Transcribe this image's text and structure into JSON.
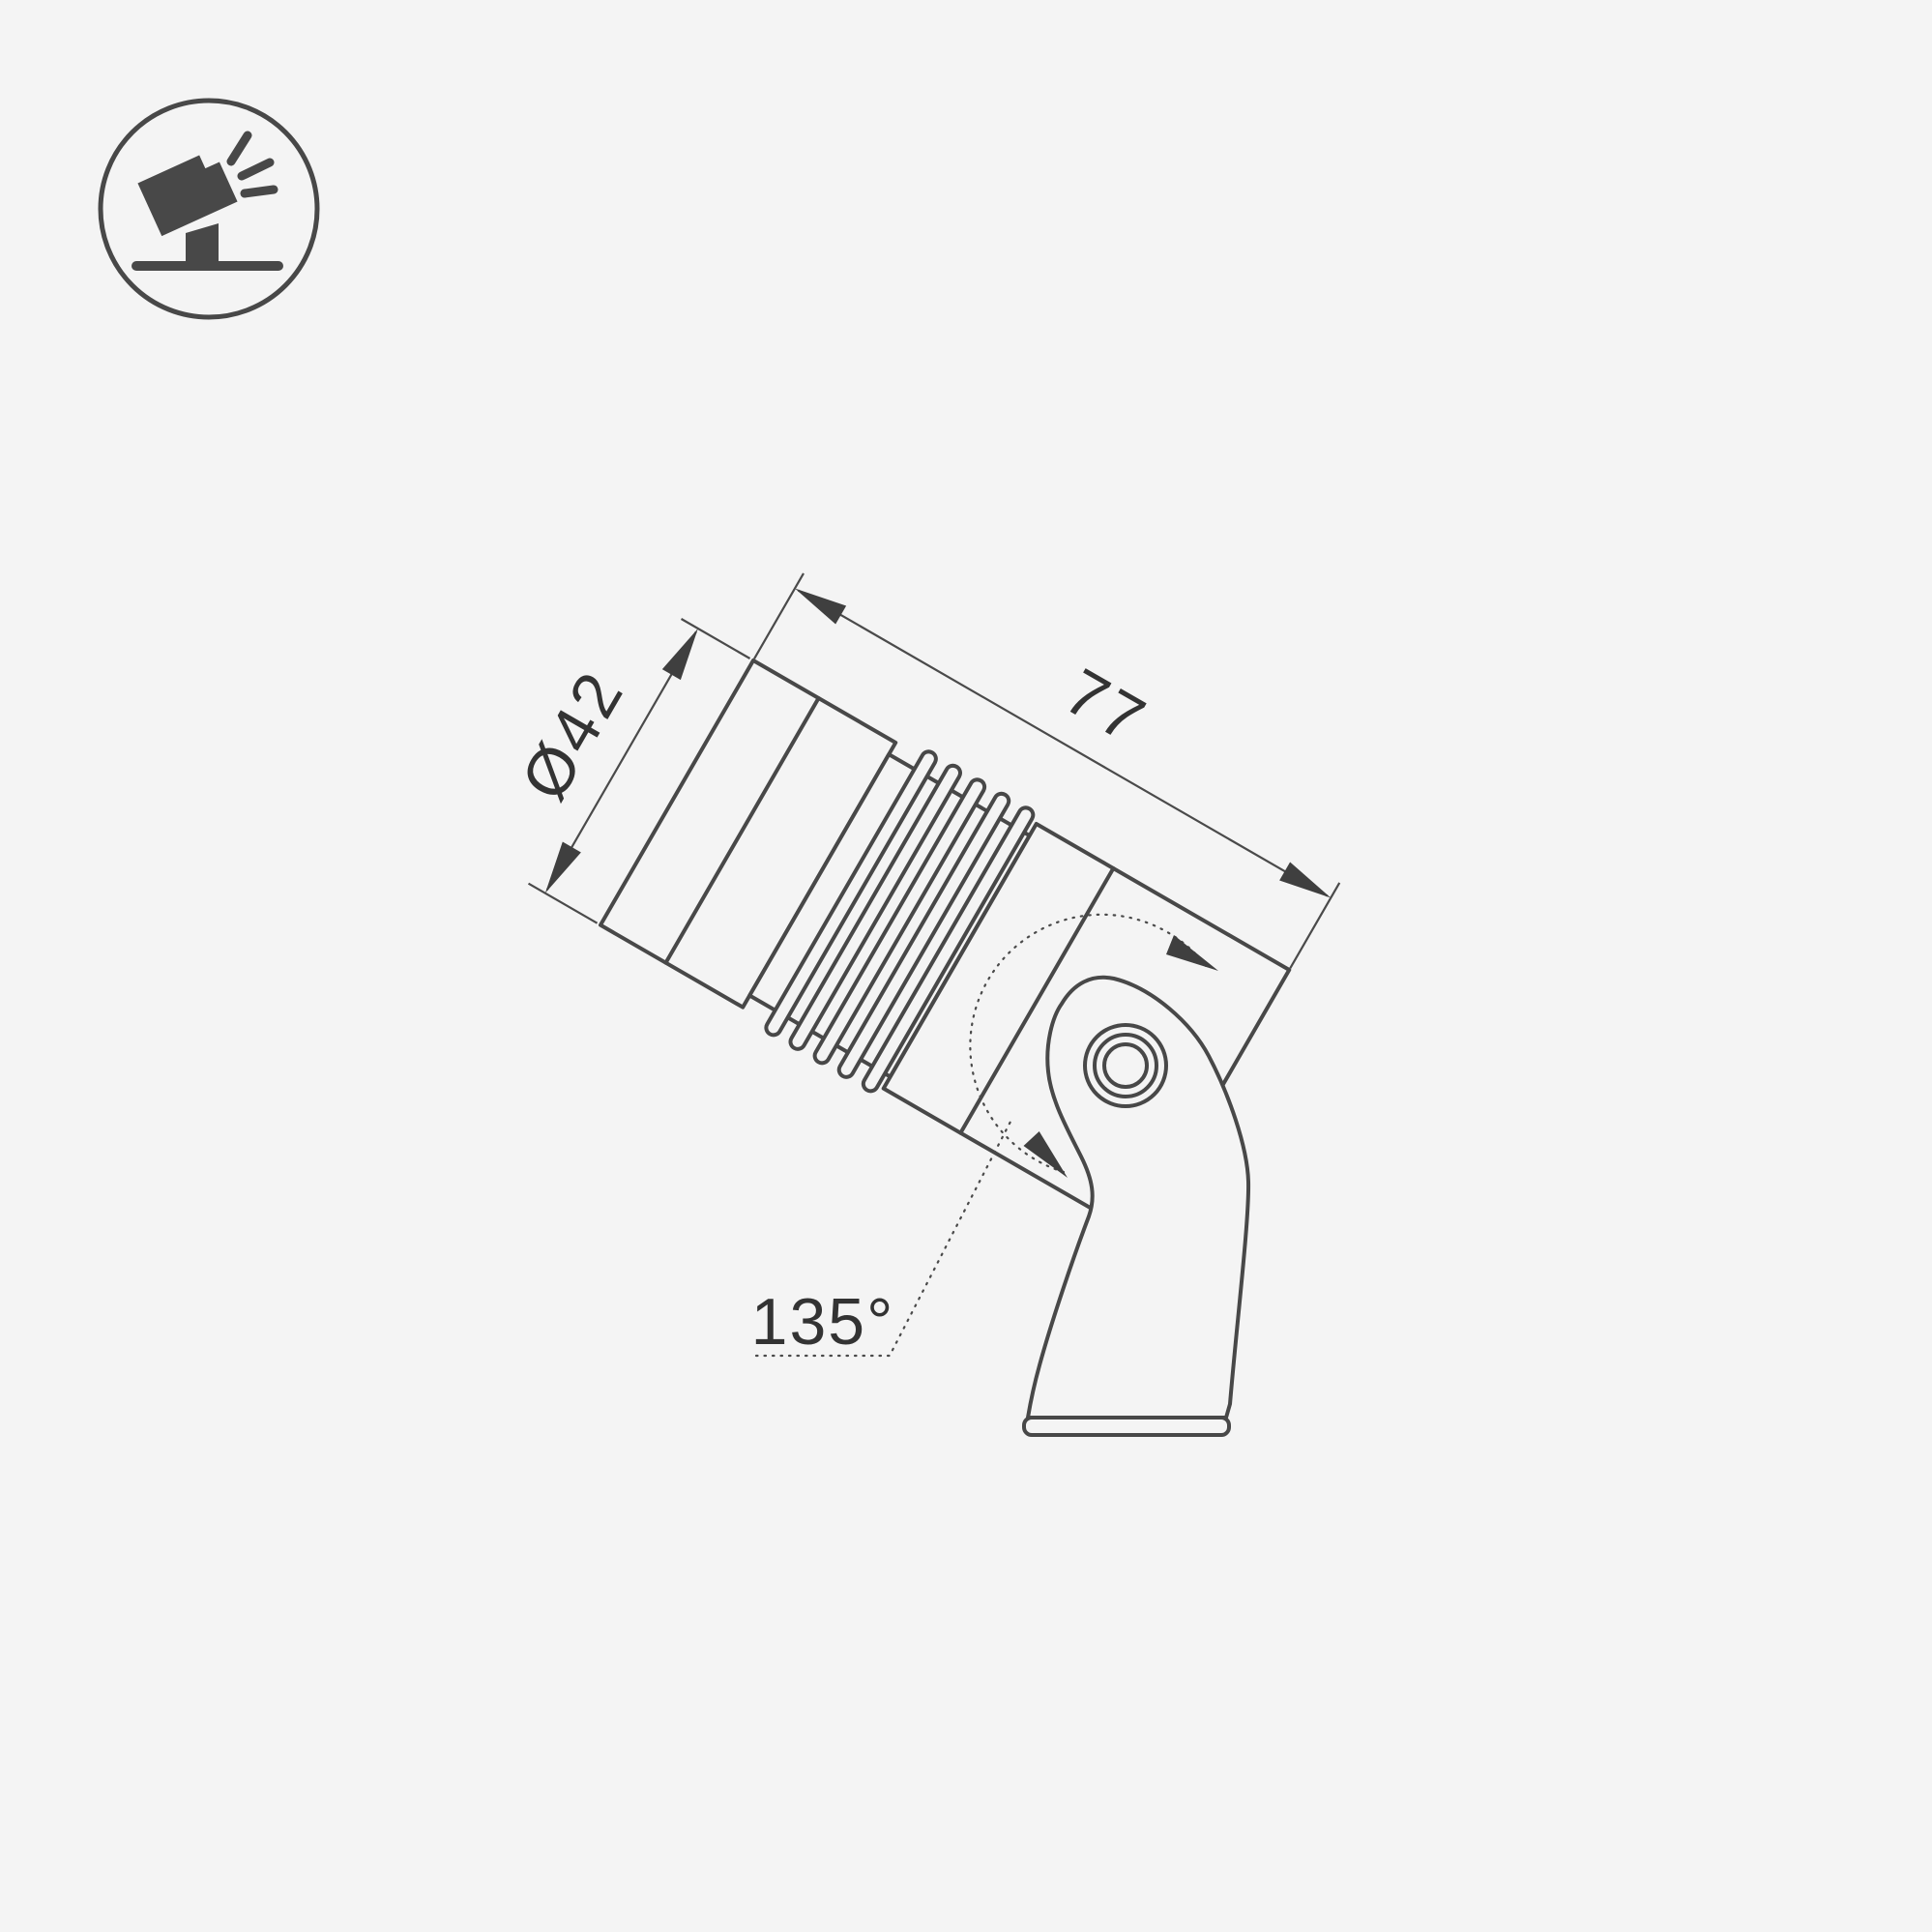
{
  "page": {
    "background": "#f4f4f4"
  },
  "drawing": {
    "colors": {
      "background": "#f4f4f4",
      "shape_fill": "#f4f4f4",
      "outline": "#484848",
      "thin_line": "#4a4a4a",
      "arrow_fill": "#3f3f3f",
      "text": "#333333"
    },
    "dimensions": {
      "diameter": {
        "label": "Ø42"
      },
      "length": {
        "label": "77"
      },
      "rotation": {
        "label": "135°"
      }
    }
  },
  "icon": {
    "name": "tilted-spotlight-icon"
  }
}
